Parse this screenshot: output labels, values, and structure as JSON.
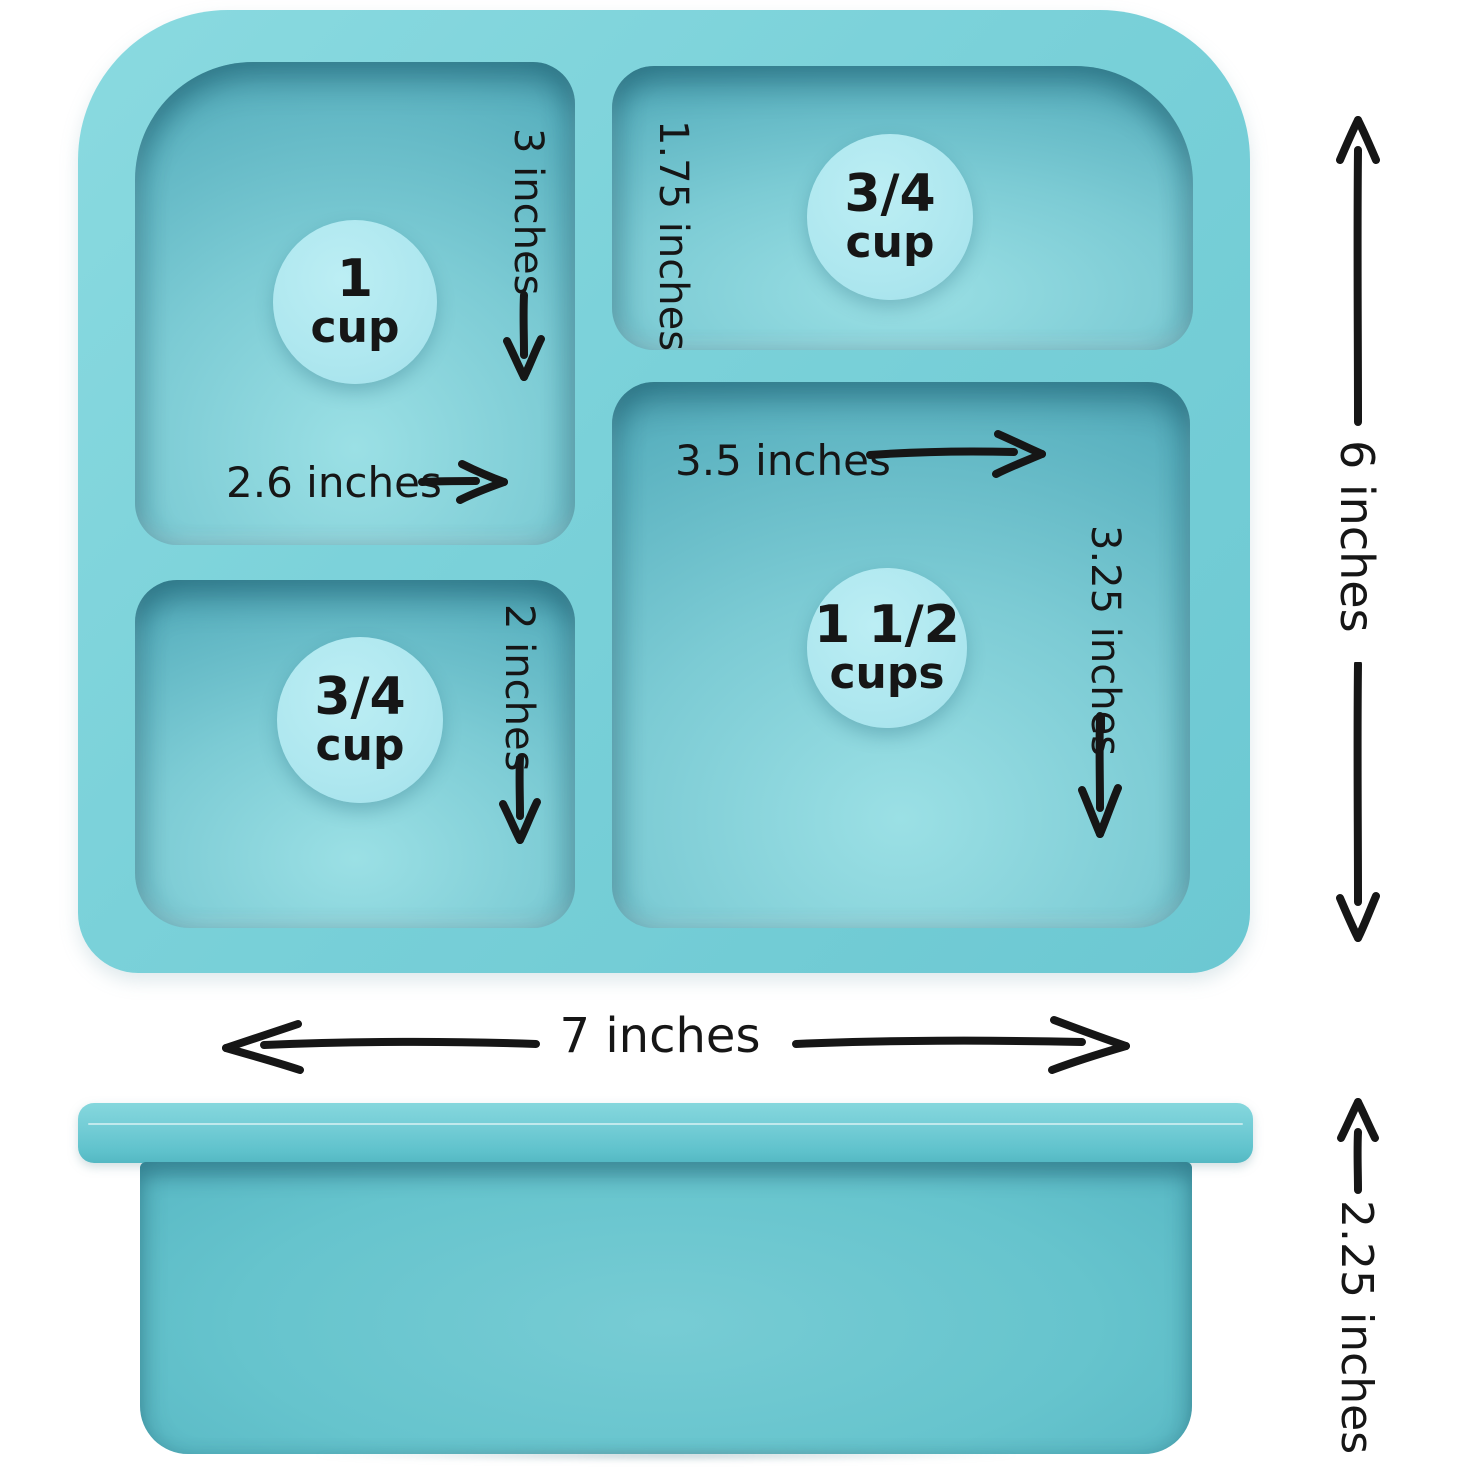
{
  "diagram": {
    "background": "#ffffff",
    "ink_color": "#161616",
    "colors": {
      "tray_rim": "#7ad1d9",
      "well_dark": "#4598a9",
      "well_light": "#9be0e5",
      "badge": "#aee7ef",
      "side_body": "#5cbcc7"
    },
    "top_view": {
      "compartments": [
        {
          "id": "top-left",
          "capacity_num": "1",
          "capacity_unit": "cup",
          "height_label": "3 inches",
          "width_label": "2.6 inches"
        },
        {
          "id": "top-right",
          "capacity_num": "3/4",
          "capacity_unit": "cup",
          "height_label": "1.75 inches"
        },
        {
          "id": "bottom-left",
          "capacity_num": "3/4",
          "capacity_unit": "cup",
          "height_label": "2 inches"
        },
        {
          "id": "right",
          "capacity_num": "1 1/2",
          "capacity_unit": "cups",
          "width_label": "3.5 inches",
          "height_label": "3.25 inches"
        }
      ],
      "overall_width_label": "7 inches",
      "overall_height_label": "6 inches"
    },
    "side_view": {
      "height_label": "2.25 inches"
    }
  }
}
